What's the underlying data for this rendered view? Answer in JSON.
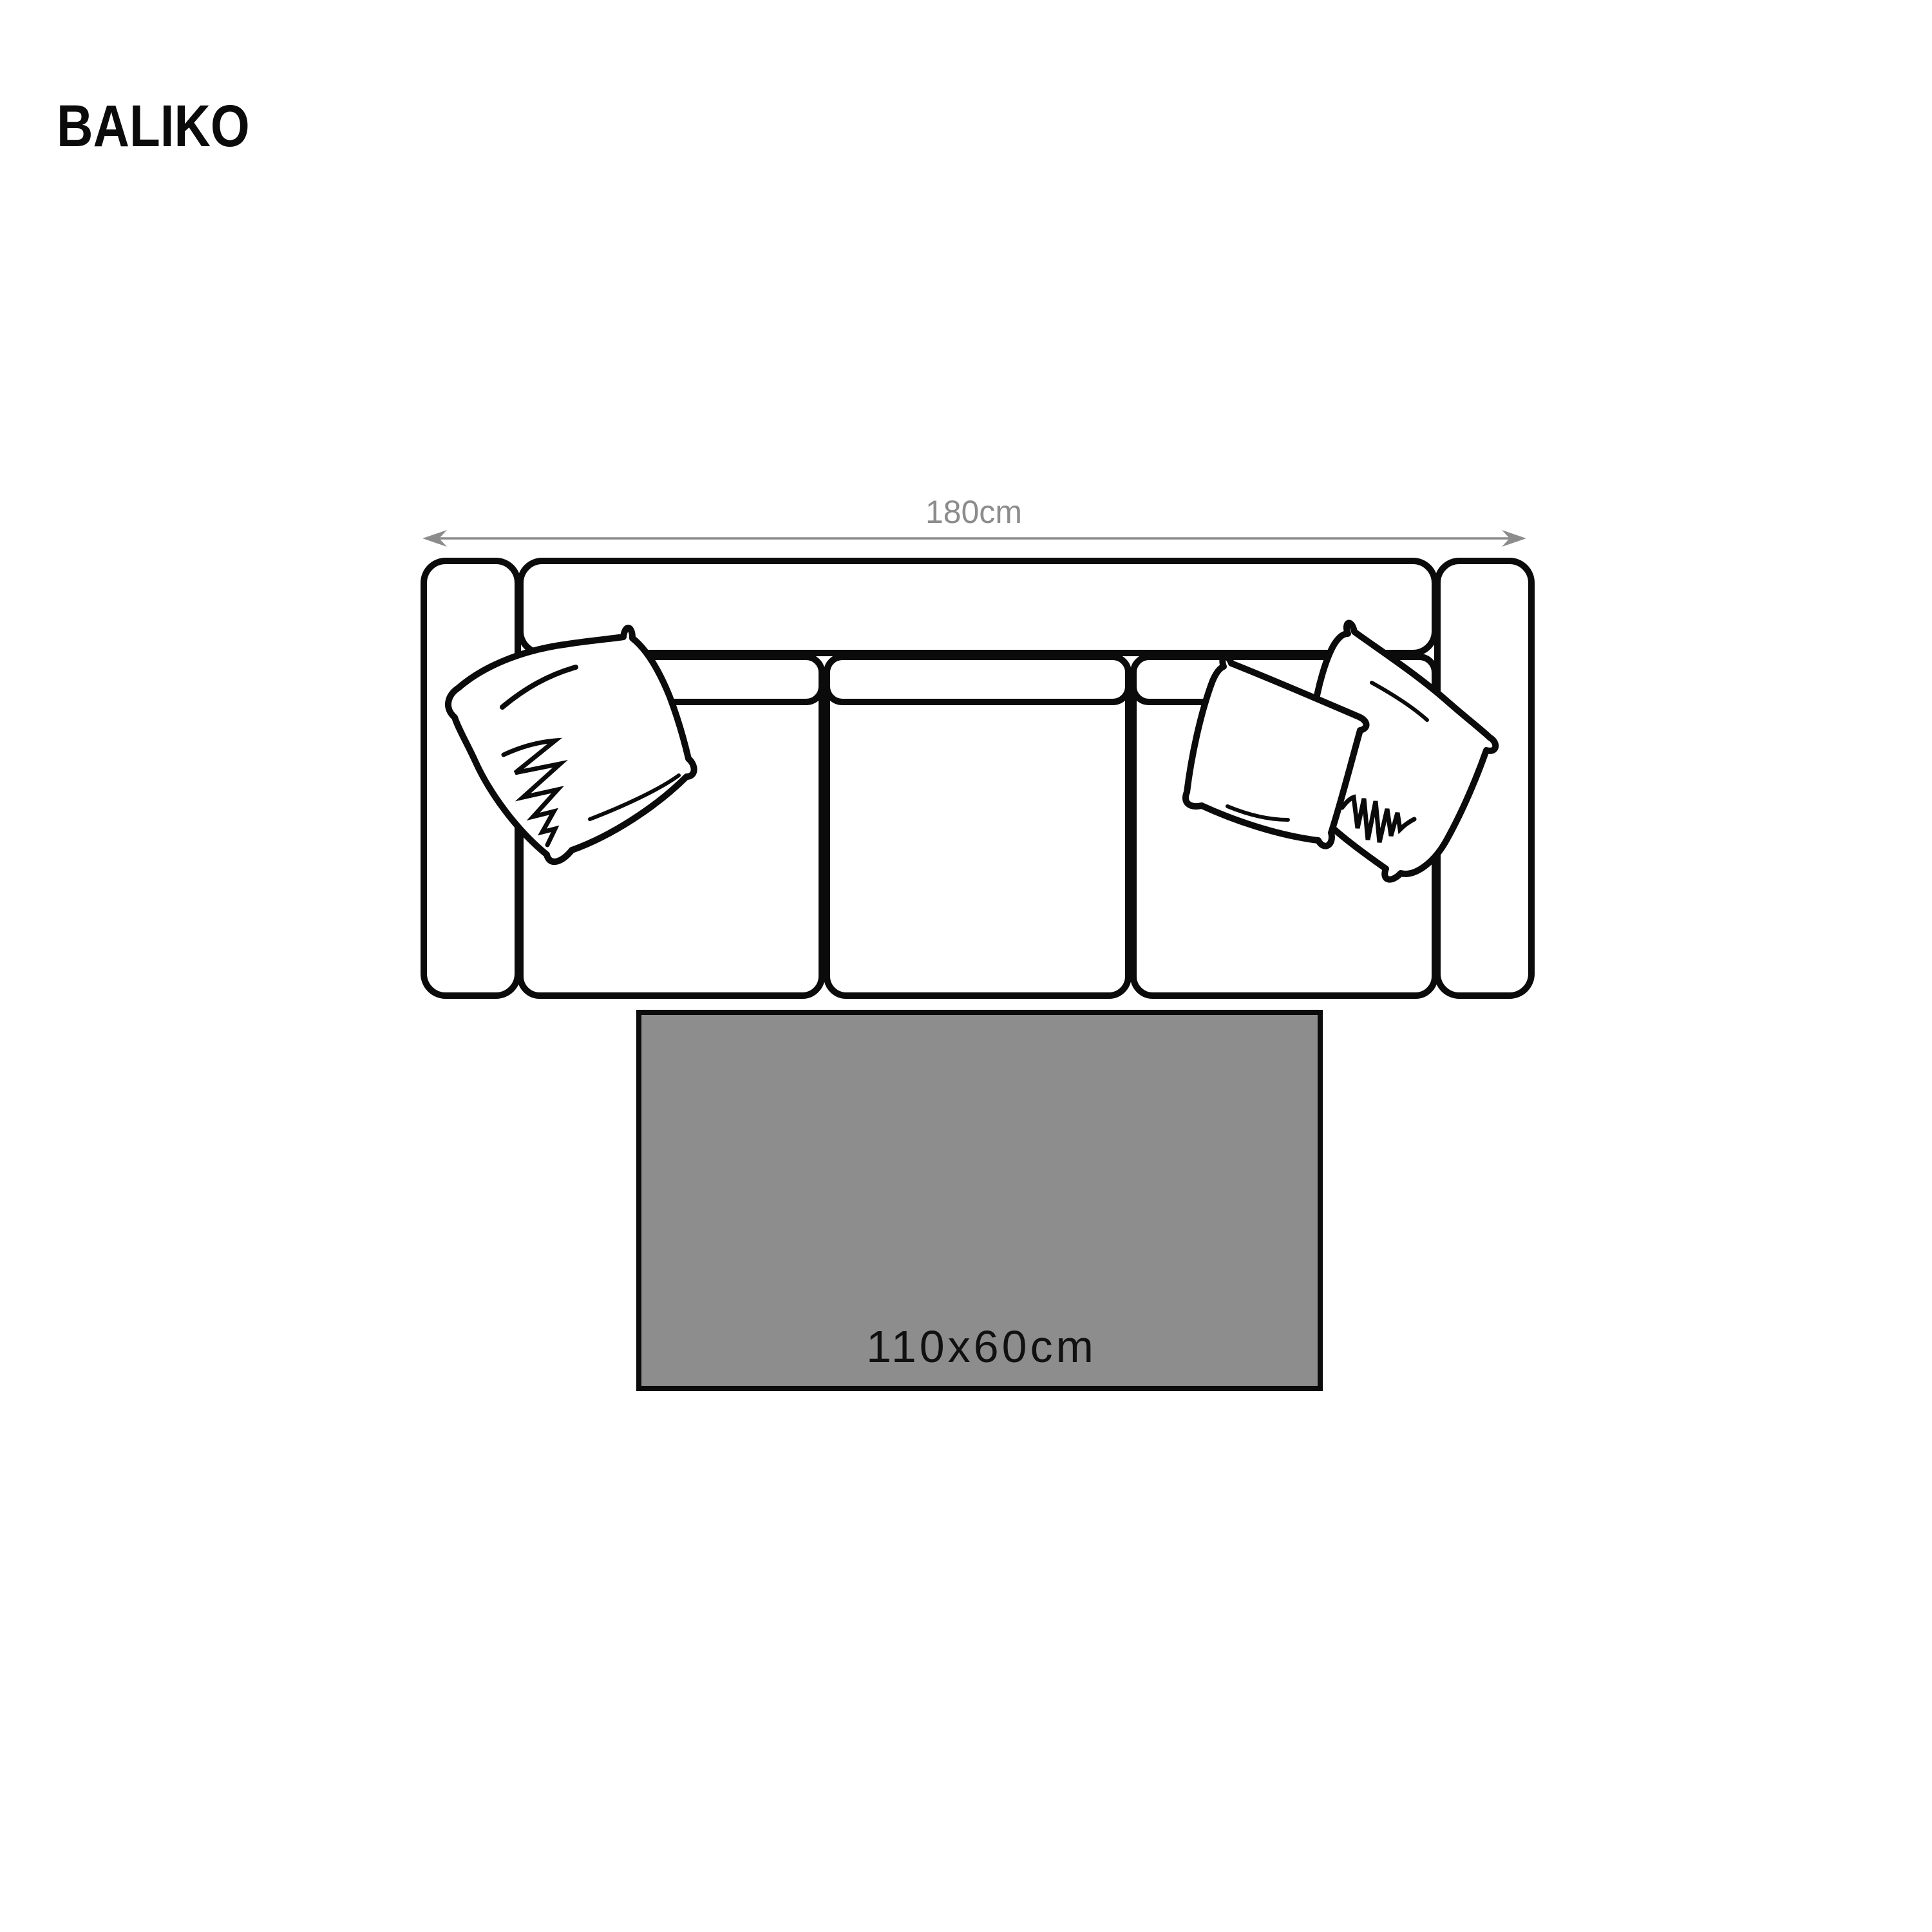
{
  "page": {
    "title": "BALIKO",
    "background": "#ffffff"
  },
  "dimension": {
    "label": "180cm",
    "color": "#8c8c8c"
  },
  "rug": {
    "label": "110x60cm",
    "fill": "#8d8d8d",
    "border": "#0b0b0b",
    "label_color": "#111111"
  },
  "sofa": {
    "outline_color": "#0b0b0b",
    "parts": [
      "left-armrest",
      "backrest",
      "seat-left",
      "seat-center",
      "seat-right",
      "back-cushion-left",
      "back-cushion-center",
      "back-cushion-right",
      "right-armrest"
    ],
    "pillows": [
      "left-pillow",
      "right-pillow-back",
      "right-pillow-front"
    ]
  }
}
